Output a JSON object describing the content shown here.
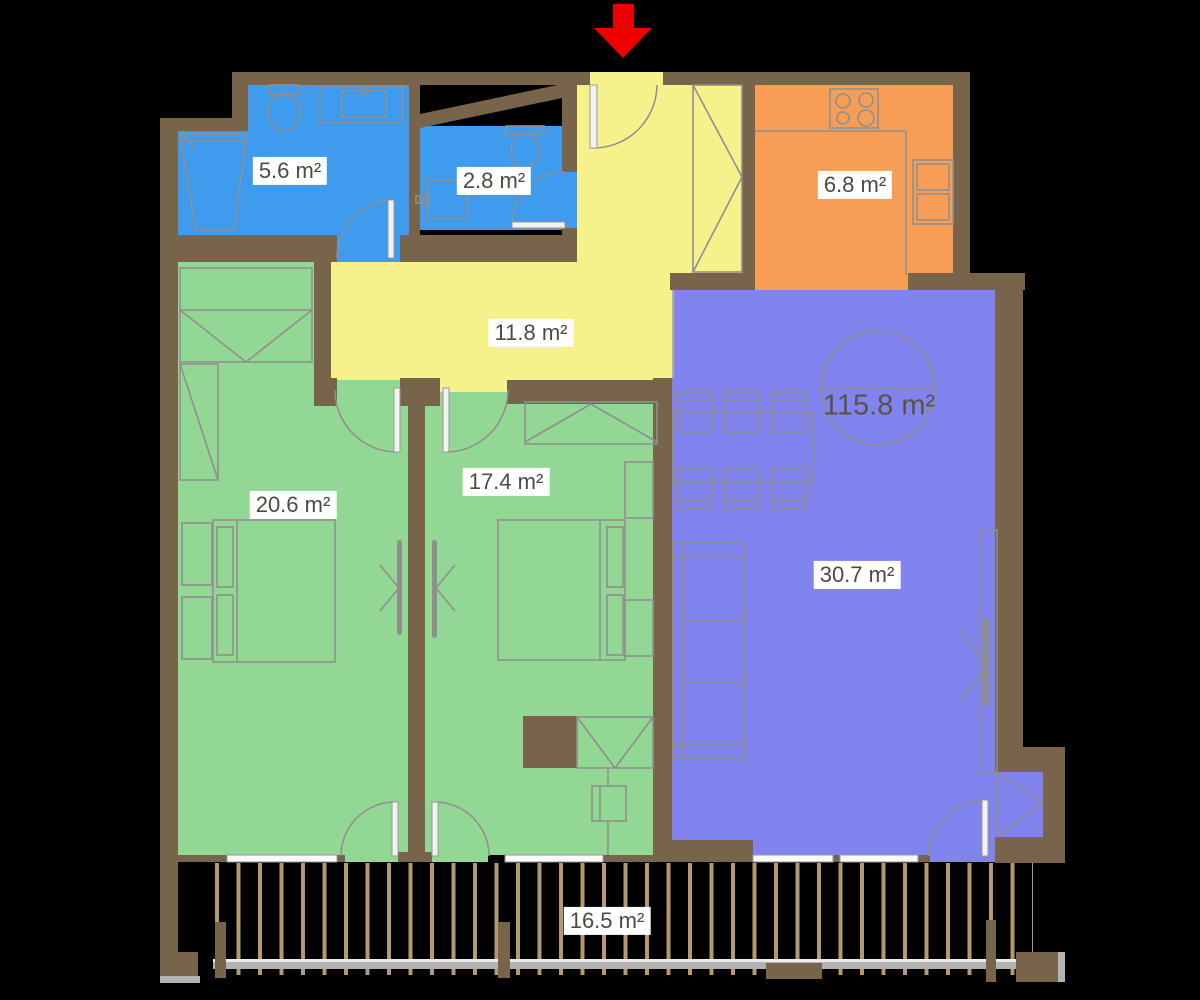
{
  "palette": {
    "background": "#000000",
    "wall": "#77644A",
    "bathroom": "#3F9BEE",
    "kitchen": "#F89D55",
    "hallway": "#F7F18C",
    "living": "#8183EF",
    "bedroom": "#93D795",
    "furniture_line": "#8F8F8F",
    "door_leaf": "#F2F2F2",
    "window": "#FAFAFA",
    "railing_post": "#B49A70",
    "railing_rail": "#B3B3B3",
    "label_text": "#4F4A42",
    "total_text": "#5B5345",
    "label_bg": "#FFFFFF",
    "entrance_arrow": "#EE0000"
  },
  "rooms": {
    "bathroom_large": {
      "label": "5.6 m²"
    },
    "bathroom_small": {
      "label": "2.8 m²"
    },
    "kitchen": {
      "label": "6.8 m²"
    },
    "hallway": {
      "label": "11.8 m²"
    },
    "living_room": {
      "label": "30.7 m²"
    },
    "bedroom_1": {
      "label": "20.6 m²"
    },
    "bedroom_2": {
      "label": "17.4 m²"
    },
    "balcony": {
      "label": "16.5 m²"
    }
  },
  "total_area": {
    "label": "115.8 m²"
  }
}
